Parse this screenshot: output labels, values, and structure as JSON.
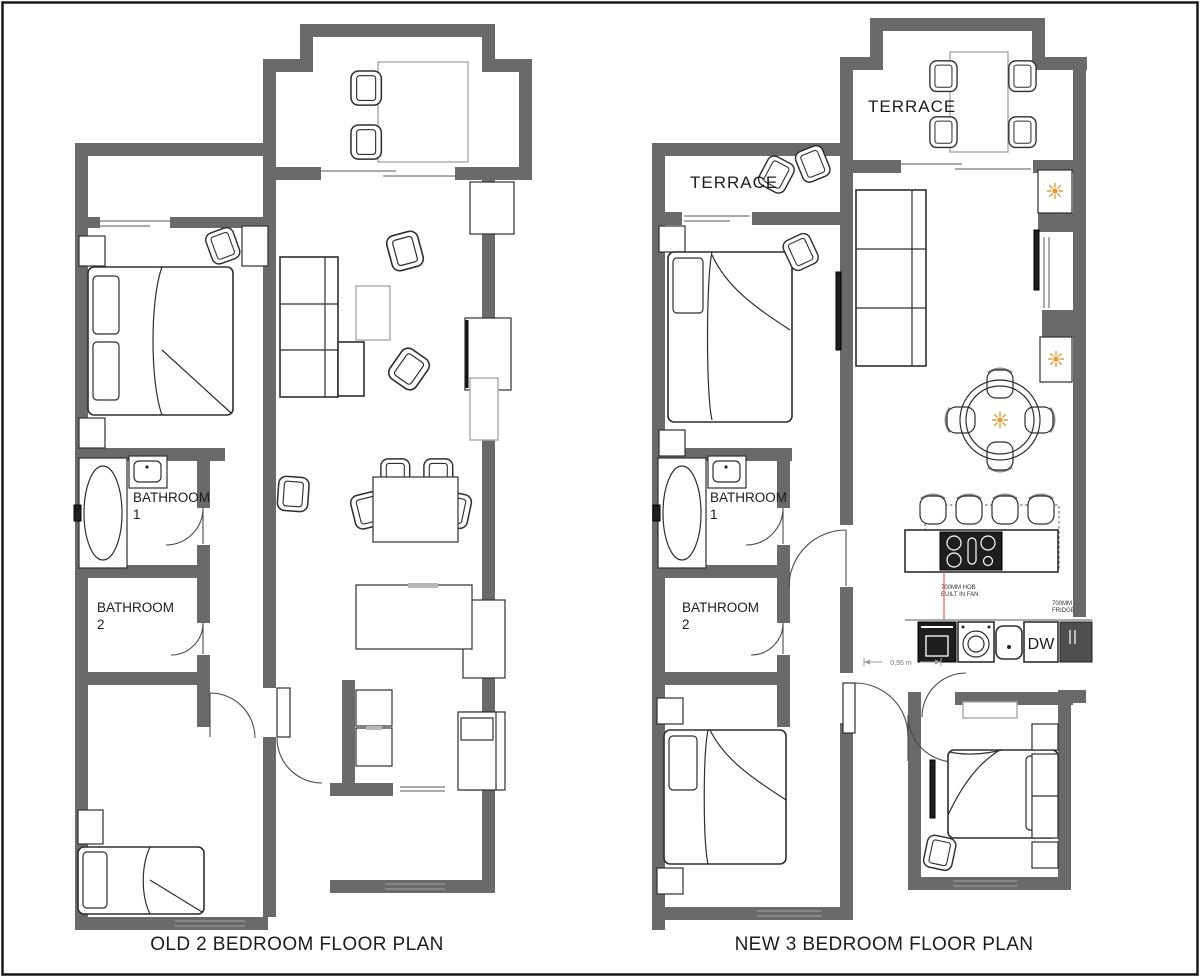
{
  "colors": {
    "wall": "#6a6a6a",
    "frame": "#1a1a1a",
    "accent_orange": "#E49A36",
    "red_line": "#E8604C"
  },
  "left_plan": {
    "title": "OLD 2 BEDROOM FLOOR PLAN",
    "bathroom1": [
      "BATHROOM",
      "1"
    ],
    "bathroom2": [
      "BATHROOM",
      "2"
    ]
  },
  "right_plan": {
    "title": "NEW 3 BEDROOM FLOOR PLAN",
    "terrace_top": "TERRACE",
    "terrace_side": "TERRACE",
    "bathroom1": [
      "BATHROOM",
      "1"
    ],
    "bathroom2": [
      "BATHROOM",
      "2"
    ],
    "dishwasher": "DW",
    "hob_note": [
      "700MM HOB",
      "BUILT IN FAN"
    ],
    "fridge_note": [
      "700MM",
      "FRIDGE"
    ],
    "dimension": "0,95 m"
  }
}
